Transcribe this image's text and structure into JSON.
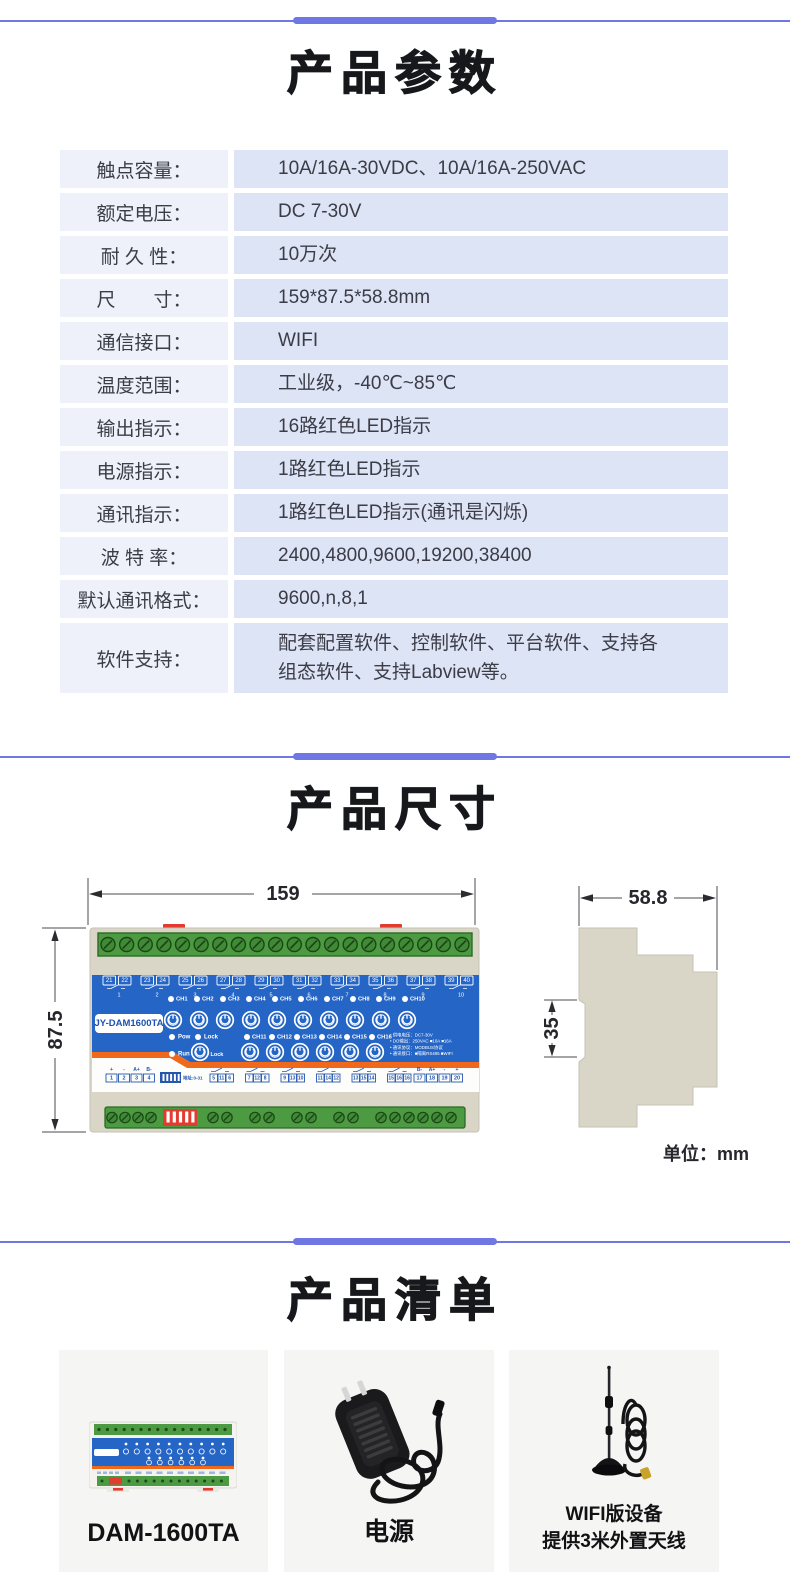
{
  "page": {
    "accent_color": "#6e77e4",
    "bg": "#ffffff"
  },
  "params": {
    "title": "产品参数",
    "label_bg": "#eef1fa",
    "value_bg": "#dde4f5",
    "rows": [
      {
        "label": "触点容量：",
        "value": "10A/16A-30VDC、10A/16A-250VAC"
      },
      {
        "label": "额定电压：",
        "value": "DC 7-30V"
      },
      {
        "label": "耐 久 性：",
        "value": "10万次"
      },
      {
        "label": "尺　　寸：",
        "value": "159*87.5*58.8mm"
      },
      {
        "label": "通信接口：",
        "value": "WIFI"
      },
      {
        "label": "温度范围：",
        "value": "工业级，-40℃~85℃"
      },
      {
        "label": "输出指示：",
        "value": "16路红色LED指示"
      },
      {
        "label": "电源指示：",
        "value": "1路红色LED指示"
      },
      {
        "label": "通讯指示：",
        "value": "1路红色LED指示(通讯是闪烁)"
      },
      {
        "label": "波 特 率：",
        "value": "2400,4800,9600,19200,38400"
      },
      {
        "label": "默认通讯格式：",
        "value": "9600,n,8,1"
      },
      {
        "label": "软件支持：",
        "value": "配套配置软件、控制软件、平台软件、支持各\n组态软件、支持Labview等。"
      }
    ]
  },
  "dimensions": {
    "title": "产品尺寸",
    "unit_note": "单位：mm",
    "front_width": "159",
    "front_height": "87.5",
    "side_depth": "58.8",
    "side_rail": "35",
    "device": {
      "badge": "JY-DAM1600TA",
      "top_terminals": [
        "21",
        "22",
        "23",
        "24",
        "25",
        "26",
        "27",
        "28",
        "29",
        "30",
        "31",
        "32",
        "33",
        "34",
        "35",
        "36",
        "37",
        "38",
        "39",
        "40"
      ],
      "relay_groups": [
        "1",
        "2",
        "3",
        "4",
        "5",
        "6",
        "7",
        "8",
        "9",
        "10"
      ],
      "ch_top": [
        "CH1",
        "CH2",
        "CH3",
        "CH4",
        "CH5",
        "CH6",
        "CH7",
        "CH8",
        "CH9",
        "CH10"
      ],
      "ch_bottom": [
        "CH11",
        "CH12",
        "CH13",
        "CH14",
        "CH15",
        "CH16"
      ],
      "status_pow": "Pow",
      "status_lock": "Lock",
      "status_run": "Run",
      "lock_button": "Lock",
      "info_lines": [
        "• 供电电压：DC7-30V",
        "• DO输出：250VAC ■10A ■16A",
        "• 通讯协议：MODBUS协议",
        "• 通讯接口：■隔离RS485 ■WIFI"
      ],
      "dip_label": "地址:0-31",
      "io_left_labels": [
        "+",
        "-",
        "A+",
        "B-"
      ],
      "io_left_terminals": [
        "1",
        "2",
        "3",
        "4"
      ],
      "io_groups": [
        [
          "5",
          "11",
          "6"
        ],
        [
          "7",
          "12",
          "8"
        ],
        [
          "9",
          "13",
          "10"
        ],
        [
          "11",
          "14",
          "12"
        ],
        [
          "13",
          "15",
          "14"
        ],
        [
          "15",
          "16",
          "16"
        ]
      ],
      "io_right_labels": [
        "B-",
        "A+",
        "-",
        "+"
      ],
      "io_right_terminals": [
        "17",
        "18",
        "19",
        "20"
      ]
    },
    "colors": {
      "panel_blue": "#2465c5",
      "terminal_green": "#4c9a41",
      "stripe_orange": "#f0681c",
      "case_beige": "#d9d5c7",
      "clip_red": "#e23b30"
    }
  },
  "checklist": {
    "title": "产品清单",
    "items": [
      {
        "label": "DAM-1600TA"
      },
      {
        "label": "电源"
      },
      {
        "label": "WIFI版设备\n提供3米外置天线"
      }
    ]
  }
}
